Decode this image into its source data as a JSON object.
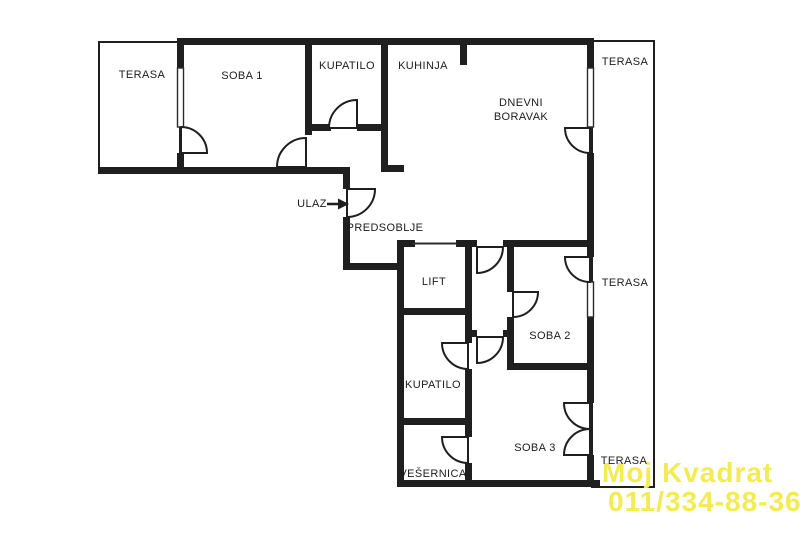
{
  "plan": {
    "rooms": {
      "terasa_top_left": "TERASA",
      "soba_1": "SOBA 1",
      "kupatilo_top": "KUPATILO",
      "kuhinja": "KUHINJA",
      "dnevni_boravak": "DNEVNI BORAVAK",
      "terasa_right_top": "TERASA",
      "predsoblje": "PREDSOBLJE",
      "lift": "LIFT",
      "soba_2": "SOBA 2",
      "terasa_right_middle": "TERASA",
      "kupatilo_bottom": "KUPATILO",
      "soba_3": "SOBA 3",
      "vesernica": "VEŠERNICA",
      "terasa_right_bottom": "TERASA"
    },
    "entrance_label": "ULAZ",
    "colors": {
      "wall": "#1f1f1f",
      "background": "#ffffff",
      "watermark_yellow": "#f3eb52"
    }
  },
  "watermark": {
    "line1": "Moj Kvadrat",
    "line2": "011/334-88-36"
  }
}
